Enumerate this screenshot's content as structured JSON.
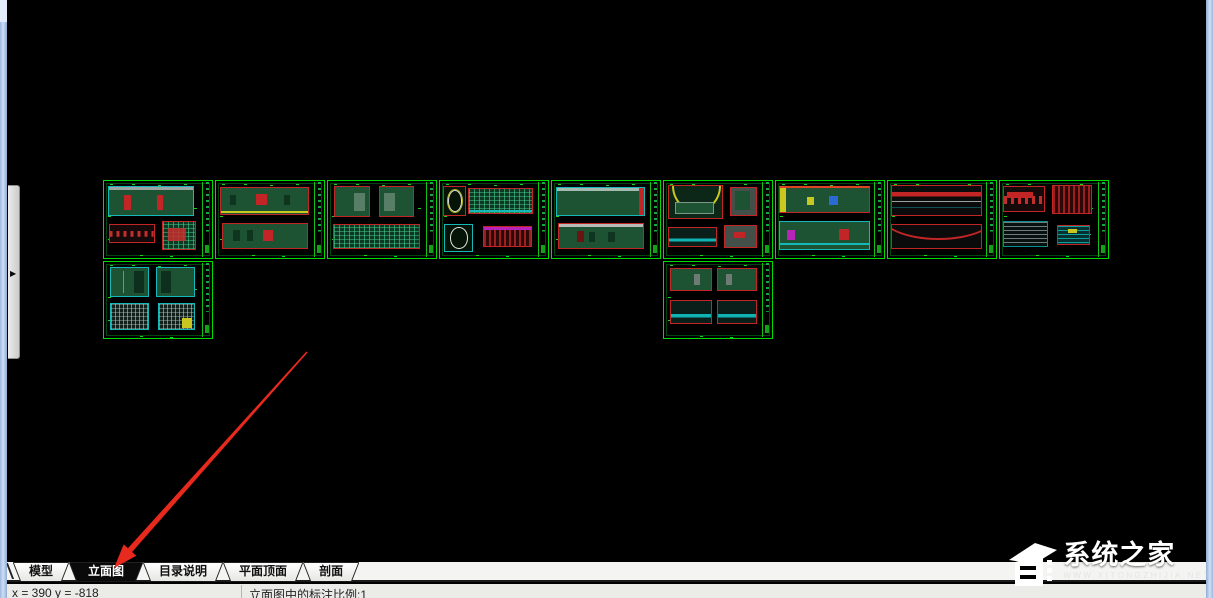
{
  "tab_bar": {
    "tabs": [
      {
        "name": "model",
        "label": "模型",
        "active": false
      },
      {
        "name": "elevation",
        "label": "立面图",
        "active": true
      },
      {
        "name": "catalog-notes",
        "label": "目录说明",
        "active": false
      },
      {
        "name": "plan-ceiling",
        "label": "平面顶面",
        "active": false
      },
      {
        "name": "section",
        "label": "剖面",
        "active": false
      }
    ]
  },
  "status_bar": {
    "coordinates": "x = 390 y = -818",
    "scale_text": "立面图中的标注比例:1"
  },
  "watermark": {
    "title": "系统之家",
    "subtext": "www.xitongzhijia.net"
  },
  "left_panel": {
    "expand_icon": "▶"
  },
  "annotation_arrow": {
    "from": {
      "x": 307,
      "y": 352
    },
    "to": {
      "x": 114,
      "y": 568
    },
    "color": "#e8291d"
  },
  "colors": {
    "canvas_bg": "#000000",
    "sheet_border": "#00dc00",
    "frame_red": "#c22525",
    "fill_green": "#1d5232",
    "cyan": "#14b8b8",
    "window_border": "#b7cdec",
    "active_tab_bg": "#0a0a0a"
  },
  "sheets": [
    {
      "x": 103,
      "y": 180,
      "w": 110,
      "h": 79,
      "panels": [
        {
          "x": 4,
          "y": 6,
          "w": 79,
          "h": 40,
          "kind": "green2",
          "marks": [
            {
              "x": 18,
              "y": 28,
              "w": 8,
              "h": 52,
              "c": "#c22525"
            },
            {
              "x": 57,
              "y": 28,
              "w": 8,
              "h": 52,
              "c": "#c22525"
            },
            {
              "x": 0,
              "y": 0,
              "w": 100,
              "h": 12,
              "c": "#9aa4a0"
            }
          ]
        },
        {
          "x": 5,
          "y": 56,
          "w": 42,
          "h": 24,
          "kind": "band",
          "marks": []
        },
        {
          "x": 54,
          "y": 52,
          "w": 31,
          "h": 38,
          "kind": "grid",
          "marks": [
            {
              "x": 16,
              "y": 22,
              "w": 55,
              "h": 48,
              "c": "rgba(200,45,45,.85)"
            }
          ]
        }
      ]
    },
    {
      "x": 215,
      "y": 180,
      "w": 110,
      "h": 79,
      "panels": [
        {
          "x": 4,
          "y": 8,
          "w": 82,
          "h": 36,
          "kind": "green",
          "marks": [
            {
              "x": 40,
              "y": 22,
              "w": 13,
              "h": 45,
              "c": "#c22525"
            },
            {
              "x": 0,
              "y": 88,
              "w": 100,
              "h": 7,
              "c": "#c8c821"
            },
            {
              "x": 10,
              "y": 25,
              "w": 7,
              "h": 42,
              "c": "#0f3520"
            },
            {
              "x": 72,
              "y": 25,
              "w": 7,
              "h": 42,
              "c": "#0f3520"
            }
          ]
        },
        {
          "x": 6,
          "y": 54,
          "w": 79,
          "h": 34,
          "kind": "green",
          "marks": [
            {
              "x": 47,
              "y": 25,
              "w": 13,
              "h": 48,
              "c": "#c22525"
            },
            {
              "x": 12,
              "y": 28,
              "w": 8,
              "h": 44,
              "c": "#0f3520"
            },
            {
              "x": 28,
              "y": 28,
              "w": 8,
              "h": 44,
              "c": "#0f3520"
            }
          ]
        }
      ]
    },
    {
      "x": 327,
      "y": 180,
      "w": 110,
      "h": 79,
      "panels": [
        {
          "x": 6,
          "y": 7,
          "w": 33,
          "h": 40,
          "kind": "green",
          "marks": [
            {
              "x": 55,
              "y": 18,
              "w": 32,
              "h": 64,
              "c": "rgba(225,230,228,.3)"
            }
          ]
        },
        {
          "x": 47,
          "y": 7,
          "w": 33,
          "h": 40,
          "kind": "green",
          "marks": [
            {
              "x": 13,
              "y": 18,
              "w": 32,
              "h": 64,
              "c": "rgba(225,230,228,.3)"
            }
          ]
        },
        {
          "x": 5,
          "y": 56,
          "w": 80,
          "h": 32,
          "kind": "grid",
          "marks": []
        }
      ]
    },
    {
      "x": 439,
      "y": 180,
      "w": 110,
      "h": 79,
      "panels": [
        {
          "x": 3,
          "y": 6,
          "w": 21,
          "h": 40,
          "kind": "circle",
          "marks": []
        },
        {
          "x": 26,
          "y": 9,
          "w": 60,
          "h": 34,
          "kind": "grid",
          "marks": [
            {
              "x": 0,
              "y": 86,
              "w": 100,
              "h": 9,
              "c": "#14b8b8"
            }
          ]
        },
        {
          "x": 4,
          "y": 56,
          "w": 27,
          "h": 36,
          "kind": "circle2",
          "marks": []
        },
        {
          "x": 40,
          "y": 58,
          "w": 45,
          "h": 28,
          "kind": "redhatch",
          "marks": [
            {
              "x": 0,
              "y": 0,
              "w": 100,
              "h": 16,
              "c": "#b823b8"
            }
          ]
        }
      ]
    },
    {
      "x": 551,
      "y": 180,
      "w": 110,
      "h": 79,
      "panels": [
        {
          "x": 4,
          "y": 8,
          "w": 82,
          "h": 37,
          "kind": "solid",
          "marks": []
        },
        {
          "x": 6,
          "y": 55,
          "w": 79,
          "h": 33,
          "kind": "green",
          "marks": [
            {
              "x": 0,
              "y": 0,
              "w": 100,
              "h": 10,
              "c": "#b8bcb8"
            },
            {
              "x": 21,
              "y": 30,
              "w": 8,
              "h": 45,
              "c": "#6b1414"
            },
            {
              "x": 36,
              "y": 34,
              "w": 7,
              "h": 40,
              "c": "#0f3520"
            },
            {
              "x": 58,
              "y": 34,
              "w": 9,
              "h": 40,
              "c": "#0f3520"
            }
          ]
        }
      ]
    },
    {
      "x": 663,
      "y": 180,
      "w": 110,
      "h": 79,
      "panels": [
        {
          "x": 4,
          "y": 5,
          "w": 51,
          "h": 44,
          "kind": "arc",
          "marks": []
        },
        {
          "x": 61,
          "y": 8,
          "w": 25,
          "h": 38,
          "kind": "gray",
          "marks": [
            {
              "x": 18,
              "y": 12,
              "w": 58,
              "h": 70,
              "c": "#1d5232"
            }
          ]
        },
        {
          "x": 4,
          "y": 60,
          "w": 45,
          "h": 26,
          "kind": "cyanline",
          "marks": []
        },
        {
          "x": 56,
          "y": 57,
          "w": 30,
          "h": 30,
          "kind": "gray",
          "marks": [
            {
              "x": 28,
              "y": 28,
              "w": 36,
              "h": 30,
              "c": "#c22525"
            }
          ]
        }
      ]
    },
    {
      "x": 775,
      "y": 180,
      "w": 110,
      "h": 79,
      "panels": [
        {
          "x": 3,
          "y": 6,
          "w": 84,
          "h": 36,
          "kind": "colorful",
          "marks": [
            {
              "x": 30,
              "y": 40,
              "w": 8,
              "h": 30,
              "c": "#c8c821"
            },
            {
              "x": 55,
              "y": 35,
              "w": 10,
              "h": 35,
              "c": "#2a6ad4"
            }
          ]
        },
        {
          "x": 3,
          "y": 52,
          "w": 84,
          "h": 37,
          "kind": "green2",
          "marks": [
            {
              "x": 8,
              "y": 30,
              "w": 9,
              "h": 36,
              "c": "#b823b8"
            },
            {
              "x": 66,
              "y": 26,
              "w": 12,
              "h": 40,
              "c": "#c22525"
            },
            {
              "x": 0,
              "y": 80,
              "w": 100,
              "h": 8,
              "c": "#14b8b8"
            }
          ]
        }
      ]
    },
    {
      "x": 887,
      "y": 180,
      "w": 110,
      "h": 79,
      "panels": [
        {
          "x": 3,
          "y": 5,
          "w": 84,
          "h": 41,
          "kind": "redline",
          "marks": []
        },
        {
          "x": 3,
          "y": 56,
          "w": 84,
          "h": 32,
          "kind": "curve",
          "marks": []
        }
      ]
    },
    {
      "x": 999,
      "y": 180,
      "w": 110,
      "h": 79,
      "panels": [
        {
          "x": 3,
          "y": 7,
          "w": 39,
          "h": 33,
          "kind": "band",
          "marks": [
            {
              "x": 8,
              "y": 18,
              "w": 64,
              "h": 26,
              "c": "#c22525"
            }
          ]
        },
        {
          "x": 48,
          "y": 5,
          "w": 37,
          "h": 38,
          "kind": "redhatch",
          "marks": []
        },
        {
          "x": 3,
          "y": 52,
          "w": 41,
          "h": 34,
          "kind": "scribble",
          "marks": []
        },
        {
          "x": 53,
          "y": 57,
          "w": 30,
          "h": 26,
          "kind": "cyanhatch",
          "marks": [
            {
              "x": 32,
              "y": 15,
              "w": 30,
              "h": 22,
              "c": "#c8c821"
            }
          ]
        }
      ]
    },
    {
      "x": 103,
      "y": 261,
      "w": 110,
      "h": 78,
      "panels": [
        {
          "x": 6,
          "y": 6,
          "w": 36,
          "h": 40,
          "kind": "green2",
          "marks": [
            {
              "x": 62,
              "y": 12,
              "w": 26,
              "h": 76,
              "c": "#0e2f1e"
            },
            {
              "x": 30,
              "y": 12,
              "w": 4,
              "h": 76,
              "c": "#14b8b8"
            }
          ]
        },
        {
          "x": 48,
          "y": 6,
          "w": 36,
          "h": 40,
          "kind": "green2",
          "marks": [
            {
              "x": 12,
              "y": 12,
              "w": 26,
              "h": 76,
              "c": "#0e2f1e"
            }
          ]
        },
        {
          "x": 6,
          "y": 54,
          "w": 36,
          "h": 36,
          "kind": "grid2",
          "marks": []
        },
        {
          "x": 50,
          "y": 54,
          "w": 34,
          "h": 36,
          "kind": "grid2",
          "marks": [
            {
              "x": 66,
              "y": 55,
              "w": 28,
              "h": 38,
              "c": "#c8c821"
            }
          ]
        }
      ]
    },
    {
      "x": 663,
      "y": 261,
      "w": 110,
      "h": 78,
      "panels": [
        {
          "x": 6,
          "y": 8,
          "w": 38,
          "h": 30,
          "kind": "green",
          "marks": [
            {
              "x": 58,
              "y": 22,
              "w": 15,
              "h": 55,
              "c": "#6e7a74"
            }
          ]
        },
        {
          "x": 49,
          "y": 8,
          "w": 37,
          "h": 30,
          "kind": "green",
          "marks": [
            {
              "x": 22,
              "y": 22,
              "w": 15,
              "h": 55,
              "c": "#6e7a74"
            }
          ]
        },
        {
          "x": 6,
          "y": 50,
          "w": 38,
          "h": 32,
          "kind": "cyanline",
          "marks": []
        },
        {
          "x": 49,
          "y": 50,
          "w": 37,
          "h": 32,
          "kind": "cyanline",
          "marks": []
        }
      ]
    }
  ]
}
